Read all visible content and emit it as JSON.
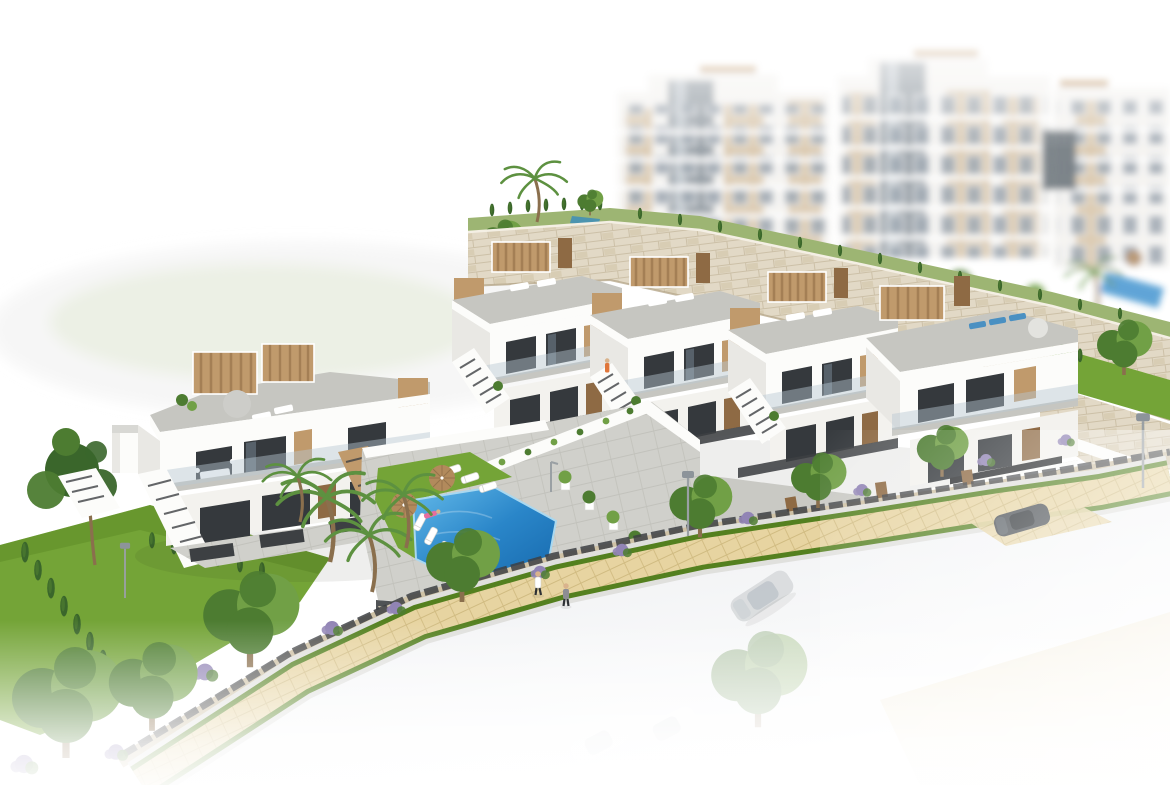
{
  "meta": {
    "title": "Aerial 3D render of a hillside residential development",
    "description": "Architectural rendering: two rows of modern white townhouses with wood pergolas, roof terraces and external stairs on a terraced hillside, a communal swimming pool with sun loungers and parasols, stone retaining walls, blurred white apartment blocks behind, gardens with palms and cypresses, and a paved sidewalk with street trees along a pale road with faded cars."
  },
  "palette": {
    "page-bg": "#ffffff",
    "hill-green": "#e9efe0",
    "hill-gray": "#ececea",
    "apt-white": "#f4f3f0",
    "apt-tan": "#d8c5a8",
    "apt-glass": "#97a1ab",
    "apt-tower": "#8c959d",
    "stone-light": "#e2d9c6",
    "stone-mid": "#cfc2a6",
    "stone-joint": "#b9ab8d",
    "roof-gray": "#c6c6c1",
    "roof-edge": "#b2b2ac",
    "facade-white": "#fcfcfa",
    "facade-shadow": "#e9e8e4",
    "facade-lower": "#f3f2ee",
    "wood": "#c09a6c",
    "wood-dark": "#8e6a44",
    "window-dark": "#35393d",
    "window-glass": "#6e7d88",
    "glass-rail": "#b7c8d2",
    "slat-dark": "#3d4043",
    "lawn": "#74a437",
    "lawn-dark": "#54801f",
    "lawn-light": "#9db573",
    "hedge": "#3a662b",
    "tree-green": "#4d7c31",
    "tree-light": "#71a046",
    "palm-green": "#5d9140",
    "trunk": "#8a6f4d",
    "pool-light": "#63b9e9",
    "pool-mid": "#2a86c9",
    "pool-deep": "#1668ac",
    "deck-gray": "#d0d0cb",
    "sidewalk-tan": "#e7d4a1",
    "sidewalk-joint": "#cdb67c",
    "road-gray": "#e9ebee",
    "white": "#ffffff",
    "car-silver": "#d5d8da",
    "car-dark": "#41464b",
    "umbrella-tan": "#b28a5c",
    "lounger-blue": "#4a90c2",
    "person-orange": "#e0763a",
    "person-pink": "#e66d9e",
    "person-skin": "#d9b38c",
    "purple-bush": "#9184b5",
    "shadow": "#20241f"
  },
  "scene": {
    "background_apartments": {
      "blocks": 3,
      "style": "white with tan panels, glass elevator towers, balcony slabs",
      "pool": {
        "present": true,
        "umbrella": "tan"
      }
    },
    "mid_row_townhouses": {
      "units": 4,
      "features": [
        "roof terraces",
        "tan wood pergolas",
        "external stairs",
        "glass balustrades",
        "dark glazing"
      ]
    },
    "corner_townhouse": {
      "garage_underpass": true,
      "roof_loungers": "blue",
      "parasol": "white"
    },
    "left_townhouse_pair": {
      "units": 2,
      "roof_parasol": "gray",
      "balcony_dining_set": "white"
    },
    "community_pool": {
      "shape": "angled rectangle",
      "loungers_white": 6,
      "umbrellas_tan": 2,
      "lawn_strip": true,
      "outdoor_shower": true,
      "potted_palms": 4
    },
    "retaining_walls": "beige stone with hedge and palm on top",
    "street": {
      "sidewalk": "tan pavers with grass verges",
      "fence": "dark slat on stone base",
      "garden_gates": 4,
      "street_lamps": 3,
      "street_trees": 5,
      "flower_bushes": "purple"
    },
    "vehicles": [
      {
        "type": "sedan",
        "color": "silver",
        "location": "road",
        "faded": true
      },
      {
        "type": "sports car",
        "color": "dark gray",
        "location": "driveway"
      },
      {
        "type": "car",
        "color": "white ghost",
        "location": "road bottom",
        "faded": true
      },
      {
        "type": "car",
        "color": "white ghost",
        "location": "road bottom",
        "faded": true
      }
    ],
    "people": [
      {
        "pose": "walking",
        "location": "sidewalk"
      },
      {
        "pose": "walking",
        "location": "sidewalk"
      },
      {
        "pose": "lounging",
        "location": "pool lawn",
        "clothing": "pink"
      },
      {
        "pose": "swimming",
        "location": "pool"
      },
      {
        "pose": "standing",
        "location": "townhouse balcony",
        "clothing": "orange"
      },
      {
        "pose": "standing",
        "location": "left house stairs",
        "clothing": "orange"
      }
    ],
    "vegetation": {
      "palms": 6,
      "cypresses": 24,
      "pine": 1,
      "lawns": 4
    }
  }
}
